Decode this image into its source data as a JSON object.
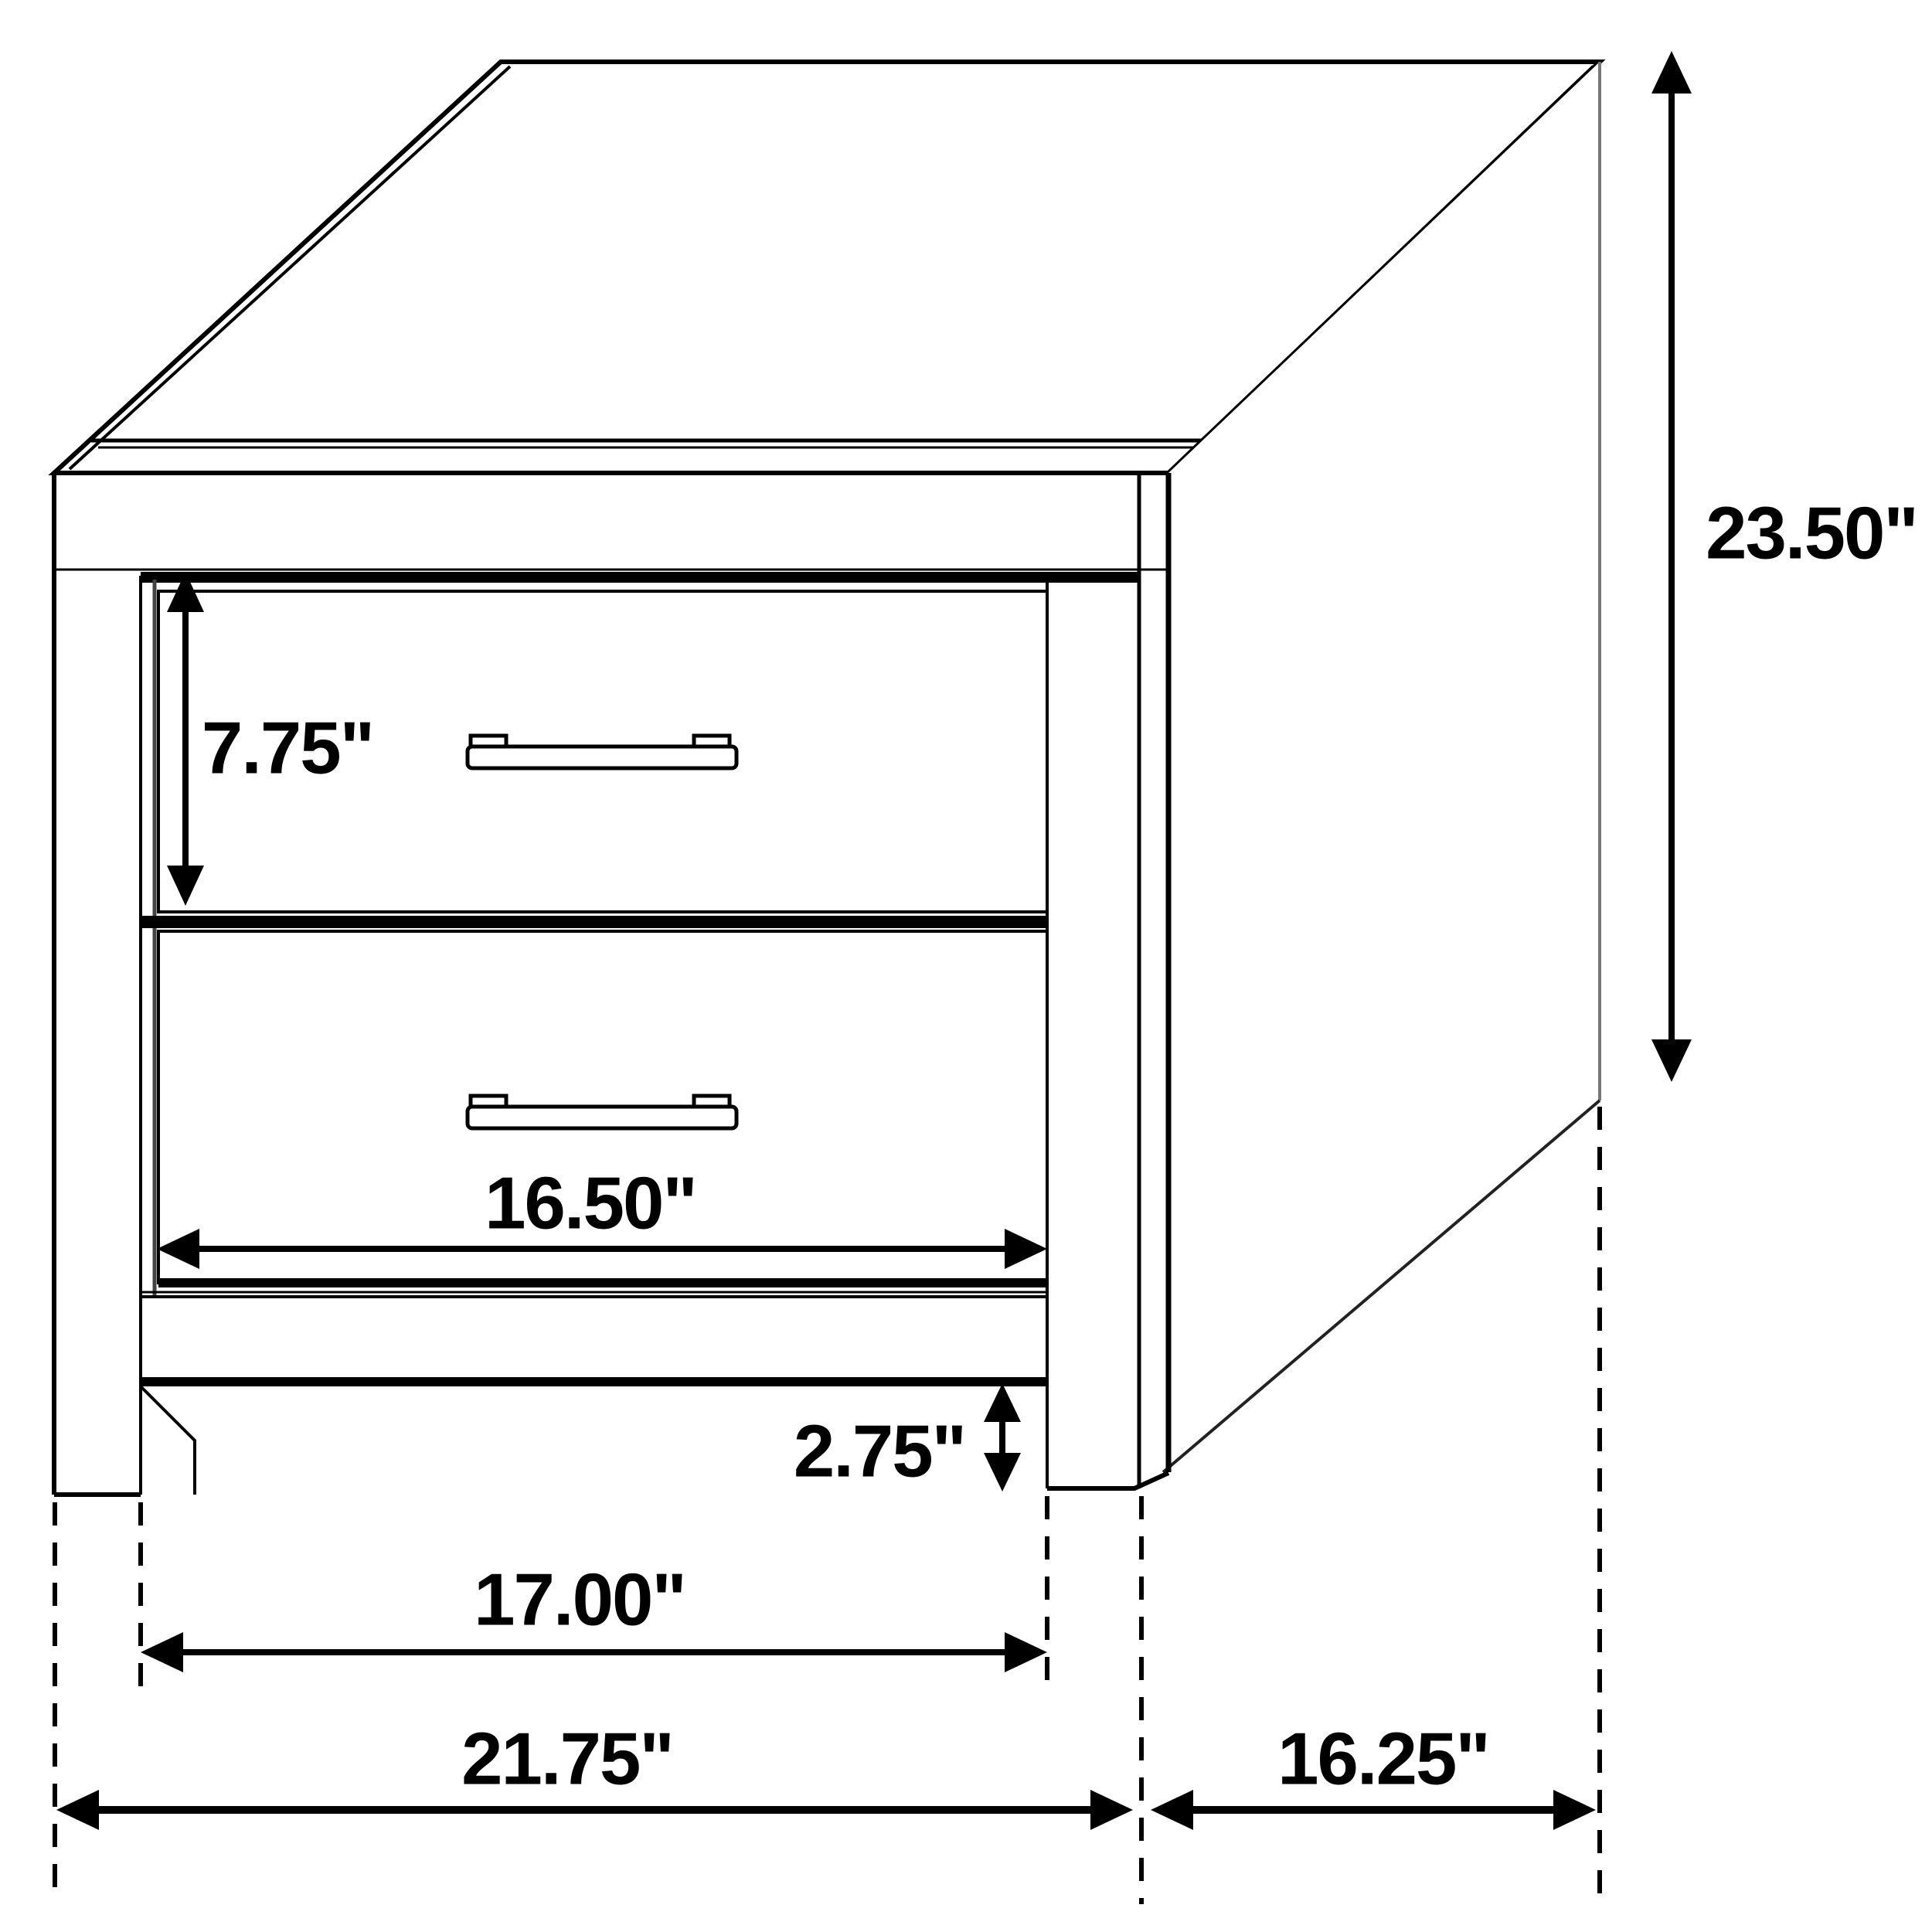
{
  "diagram": {
    "type": "furniture-dimension-drawing",
    "background_color": "#ffffff",
    "line_color": "#000000",
    "dimensions": {
      "overall_height": "23.50\"",
      "drawer_height": "7.75\"",
      "drawer_width": "16.50\"",
      "leg_height": "2.75\"",
      "inner_width": "17.00\"",
      "overall_width": "21.75\"",
      "overall_depth": "16.25\""
    }
  }
}
